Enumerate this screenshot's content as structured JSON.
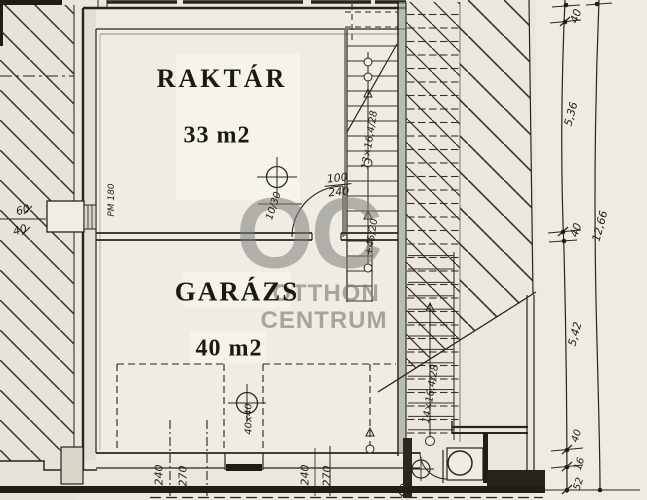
{
  "rooms": [
    {
      "name": "RAKTÁR",
      "area": "33 m2"
    },
    {
      "name": "GARÁZS",
      "area": "40 m2"
    }
  ],
  "watermark": {
    "logo": "OC",
    "line1": "OTTHON",
    "line2": "CENTRUM"
  },
  "dims": {
    "right": [
      "40",
      "5,36",
      "40",
      "5,42",
      "40",
      "16",
      "52"
    ],
    "total_right": "12,66",
    "left_pillar": [
      "60",
      "40"
    ],
    "bottom_left": [
      "240",
      "270"
    ],
    "bottom_right": [
      "240",
      "270"
    ],
    "interior_door": {
      "width": "100",
      "height": "240"
    },
    "bottom_door": "100",
    "column_marker": "40x40",
    "beam_marker": "10/30",
    "parapet": "PM 180",
    "stair_upper": "13×16,4/28",
    "stair_lower": "14×16,4/28",
    "level_mark": "+45/20"
  },
  "colors": {
    "paper": "#eae7df",
    "ink": "#29251d",
    "watermark_gray": "#8f8f8a",
    "wall_tint": "#9aa39b"
  }
}
